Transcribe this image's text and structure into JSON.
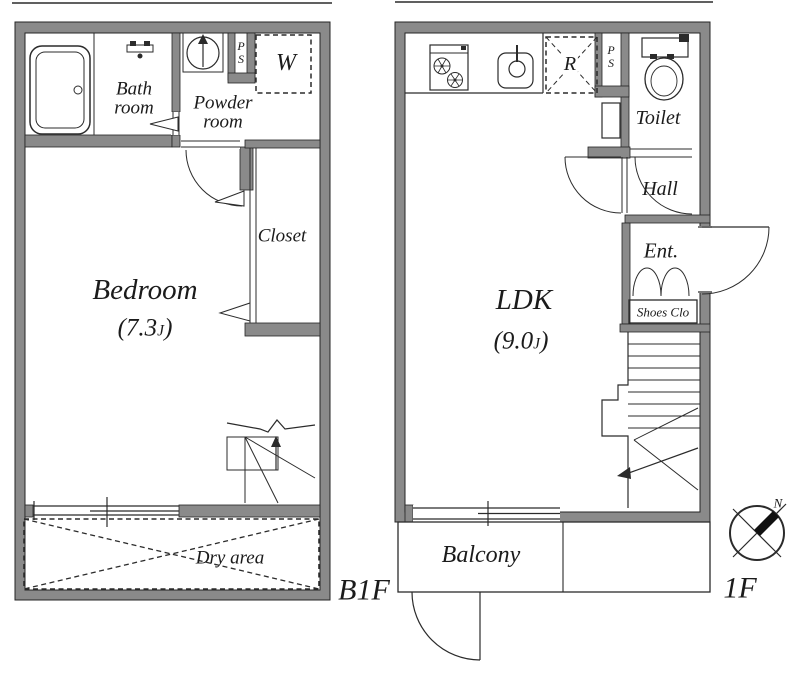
{
  "colors": {
    "wall": "#8a8a8a",
    "line": "#2b2b2b",
    "text": "#1b1b1b"
  },
  "b1f": {
    "floor_label": "B1F",
    "bathroom": {
      "lines": [
        "Bath",
        "room"
      ]
    },
    "powder_room": {
      "lines": [
        "Powder",
        "room"
      ]
    },
    "pipe_space": {
      "lines": [
        "P",
        "S"
      ]
    },
    "washer_space_label": "W",
    "closet_label": "Closet",
    "bedroom": {
      "name": "Bedroom",
      "size_open": "(7.3",
      "size_unit": "J",
      "size_close": ")"
    },
    "dry_area_label": "Dry area"
  },
  "f1": {
    "floor_label": "1F",
    "ldk": {
      "name": "LDK",
      "size_open": "(9.0",
      "size_unit": "J",
      "size_close": ")"
    },
    "fridge_space_label": "R",
    "pipe_space": {
      "lines": [
        "P",
        "S"
      ]
    },
    "toilet_label": "Toilet",
    "hall_label": "Hall",
    "entrance_label": "Ent.",
    "shoes_closet_label": "Shoes Clo",
    "balcony_label": "Balcony"
  },
  "compass": {
    "north_label": "N"
  }
}
